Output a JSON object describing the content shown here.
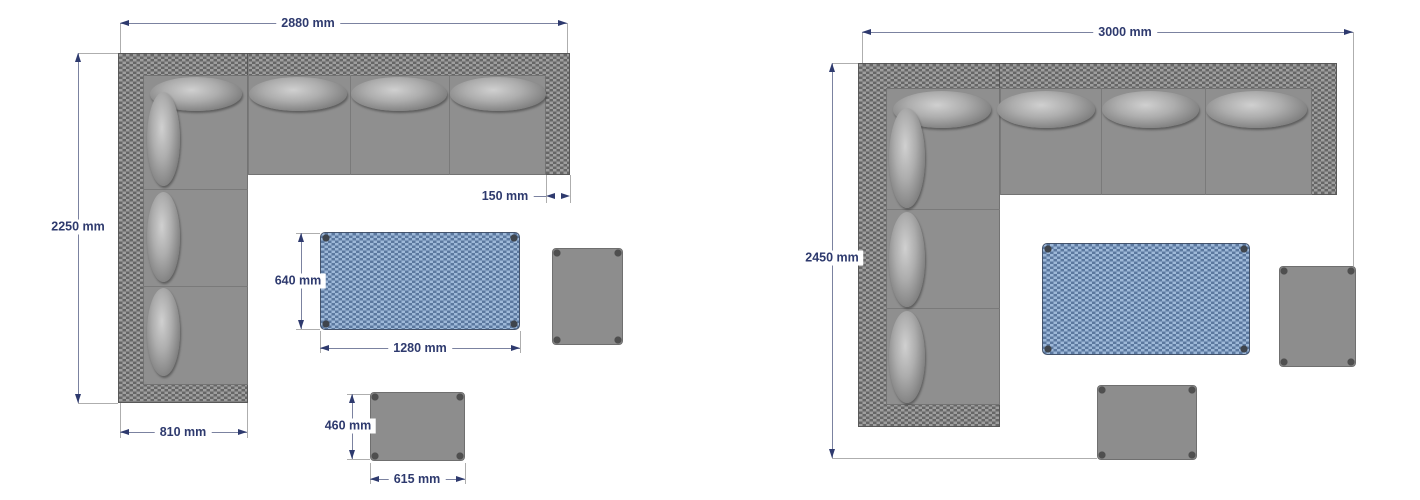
{
  "figure": {
    "type": "furniture-dimension-diagram",
    "background": "#ffffff",
    "units": "mm"
  },
  "style": {
    "dimension_text_color": "#2e3a6e",
    "dimension_line_color": "#7b82a0",
    "extension_line_color": "#aeaeae",
    "rattan_frame_color": "#7e7e7e",
    "cushion_color": "#8f8f8f",
    "table_color": "#7d9ec9",
    "stool_color": "#8d8d8d"
  },
  "left_set": {
    "name": "corner-sofa-set-2880",
    "sofa": {
      "overall_width": "2880 mm",
      "overall_depth": "2250 mm",
      "armrest_width": "150 mm",
      "chaise_width": "810 mm"
    },
    "table": {
      "length": "1280 mm",
      "depth": "640 mm"
    },
    "footstool": {
      "length": "615 mm",
      "depth": "460 mm"
    }
  },
  "right_set": {
    "name": "corner-sofa-set-3000",
    "sofa": {
      "overall_width": "3000 mm",
      "overall_depth": "2450 mm"
    }
  }
}
